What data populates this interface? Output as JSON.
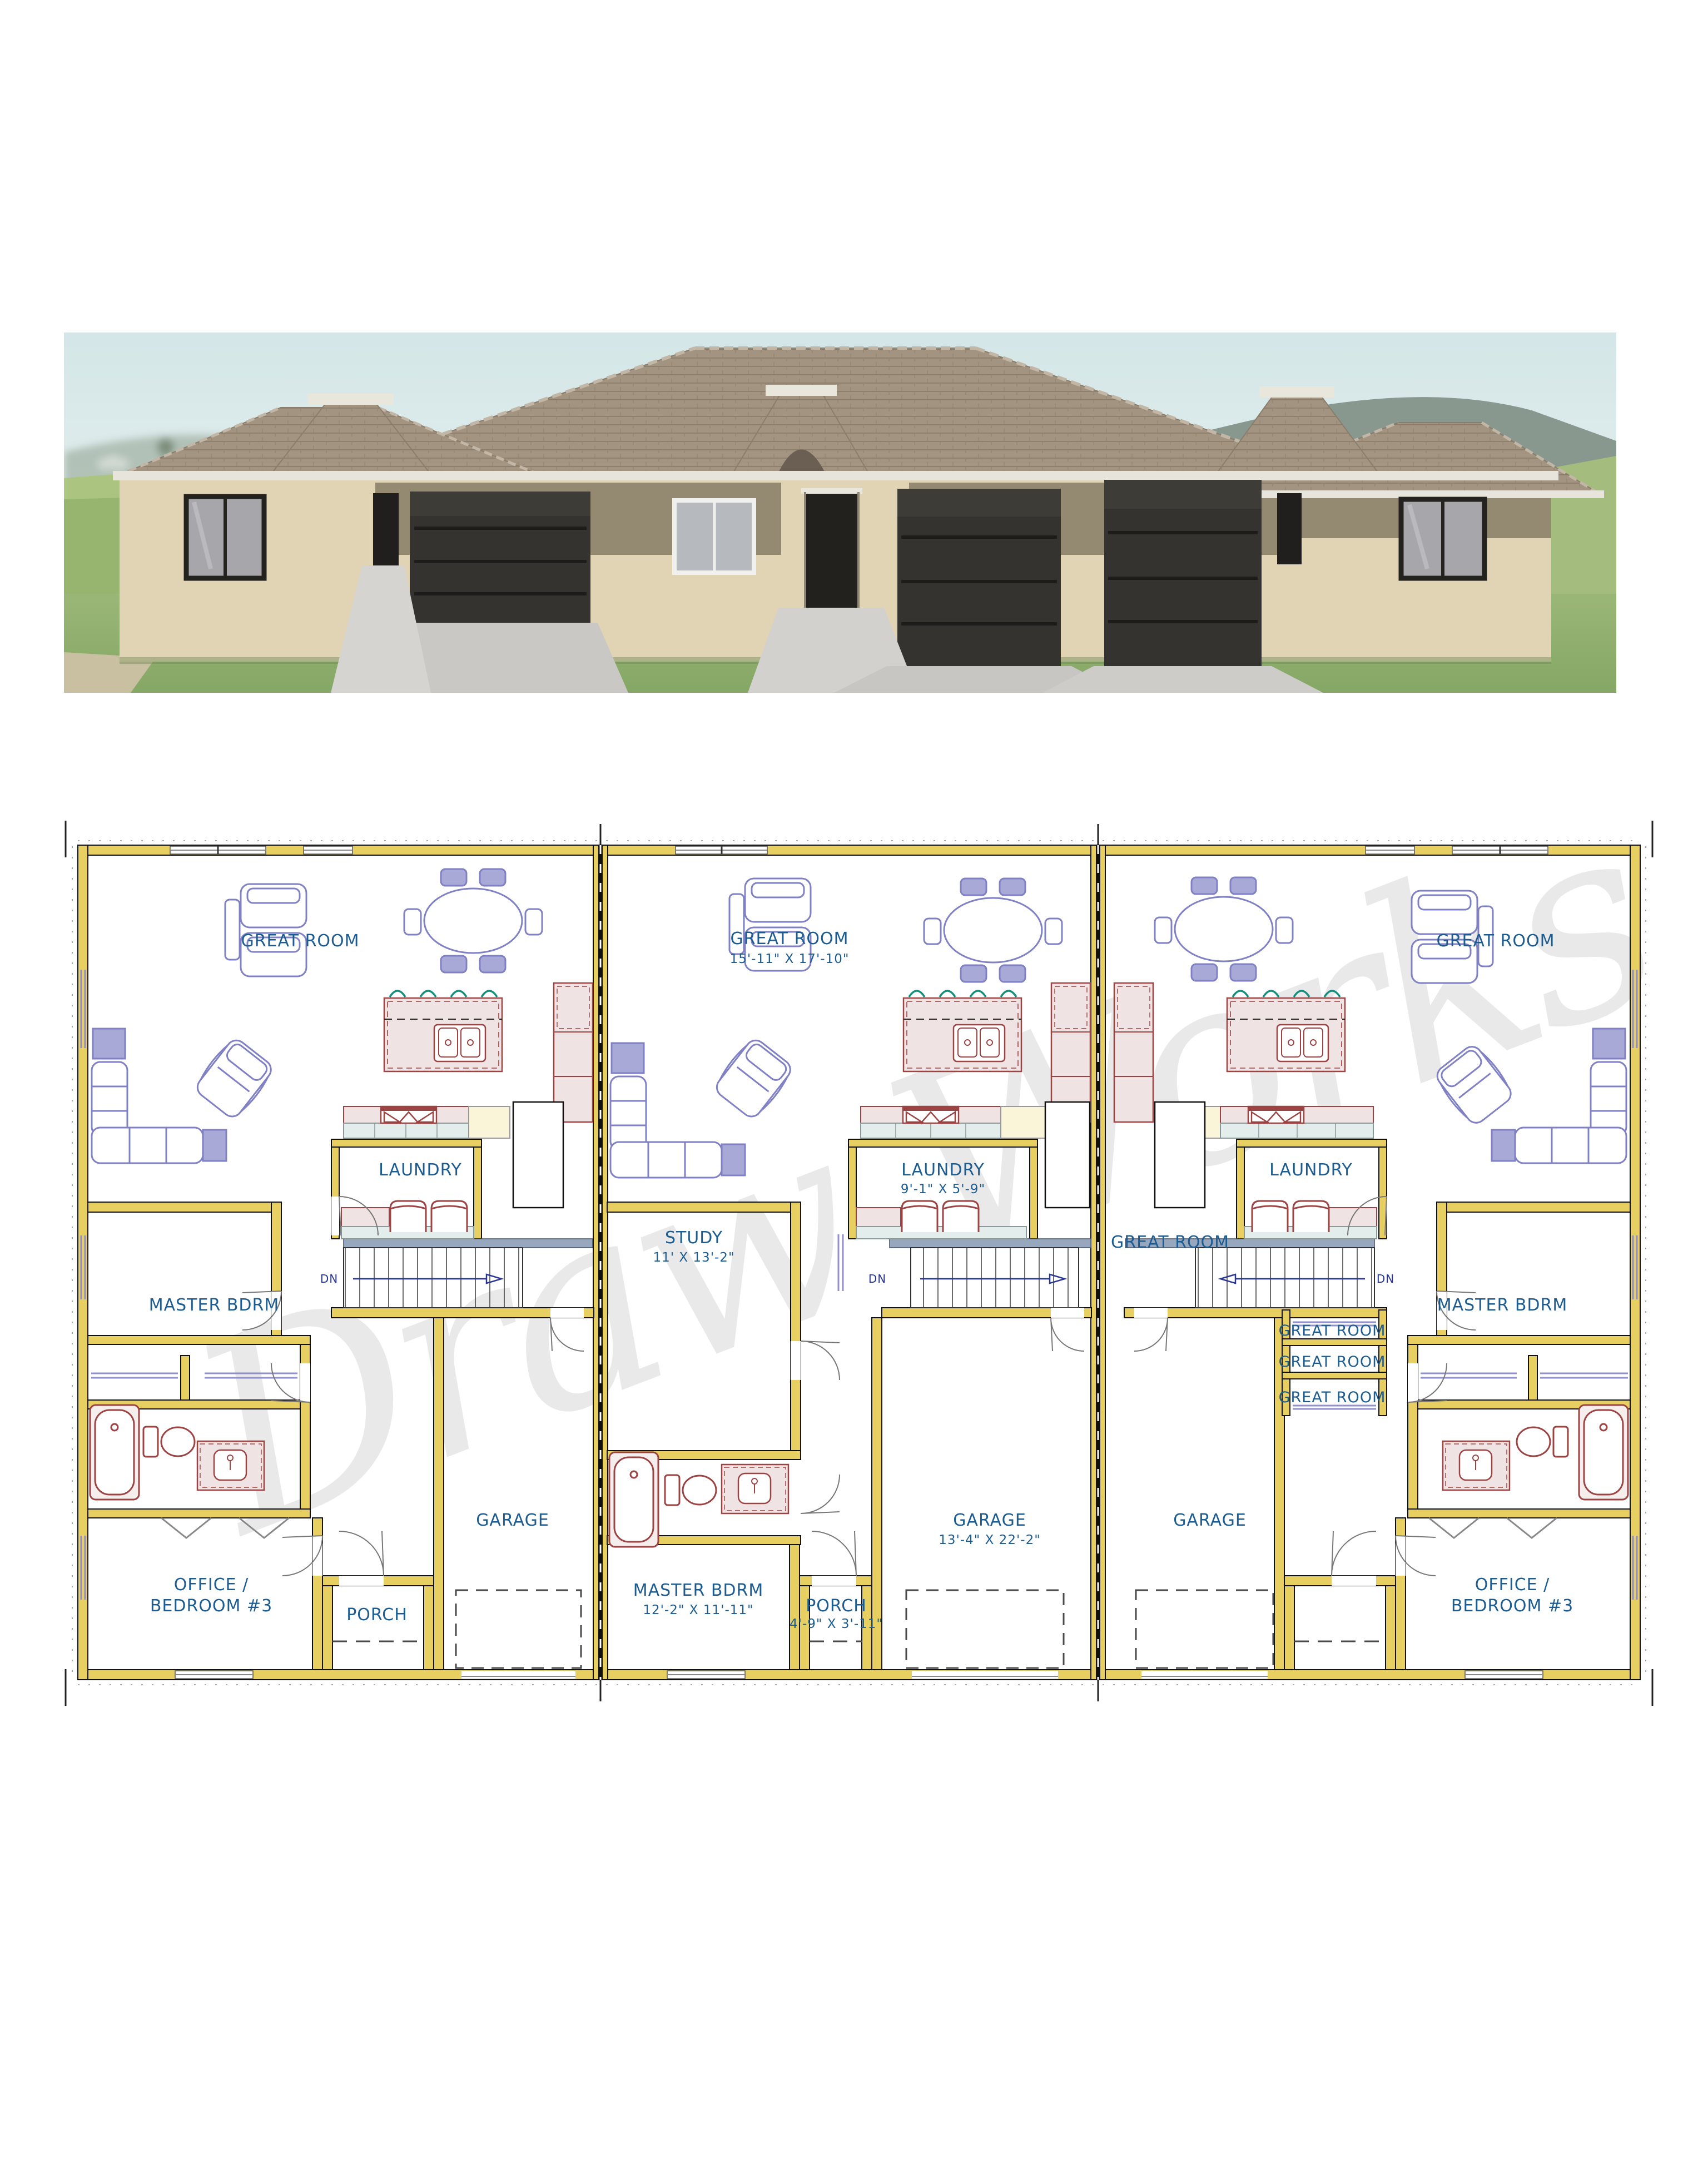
{
  "watermark": "Draw Works",
  "colors": {
    "wall_fill": "#e7cf62",
    "label_blue": "#1d5c90",
    "furniture_blue": "#8080c4",
    "cabinet_red": "#9c4343",
    "stool_teal": "#12907e",
    "stair_band": "#97a7bd",
    "roof_tan": "#a39482",
    "stucco_cream": "#e0d4b4",
    "stucco_band": "#948a71",
    "garage_door_dark": "#34332f",
    "grass_green": "#8fb16c"
  },
  "plan": {
    "left": {
      "great_room": "GREAT ROOM",
      "master": "MASTER BDRM",
      "laundry": "LAUNDRY",
      "garage": "GARAGE",
      "office_line1": "OFFICE /",
      "office_line2": "BEDROOM #3",
      "porch": "PORCH",
      "dn": "DN"
    },
    "middle": {
      "great_room": "GREAT ROOM",
      "great_room_dim": "15'-11\" X 17'-10\"",
      "study": "STUDY",
      "study_dim": "11' X 13'-2\"",
      "laundry": "LAUNDRY",
      "laundry_dim": "9'-1\" X 5'-9\"",
      "master": "MASTER BDRM",
      "master_dim": "12'-2\" X 11'-11\"",
      "garage": "GARAGE",
      "garage_dim": "13'-4\" X 22'-2\"",
      "porch": "PORCH",
      "porch_dim": "4'-9\" X 3'-11\"",
      "dn": "DN"
    },
    "right": {
      "great_room": "GREAT ROOM",
      "great_room_side": "GREAT ROOM",
      "closet_a": "GREAT ROOM",
      "closet_b": "GREAT ROOM",
      "closet_c": "GREAT ROOM",
      "laundry": "LAUNDRY",
      "master": "MASTER BDRM",
      "garage": "GARAGE",
      "office_line1": "OFFICE /",
      "office_line2": "BEDROOM #3",
      "dn": "DN"
    }
  }
}
